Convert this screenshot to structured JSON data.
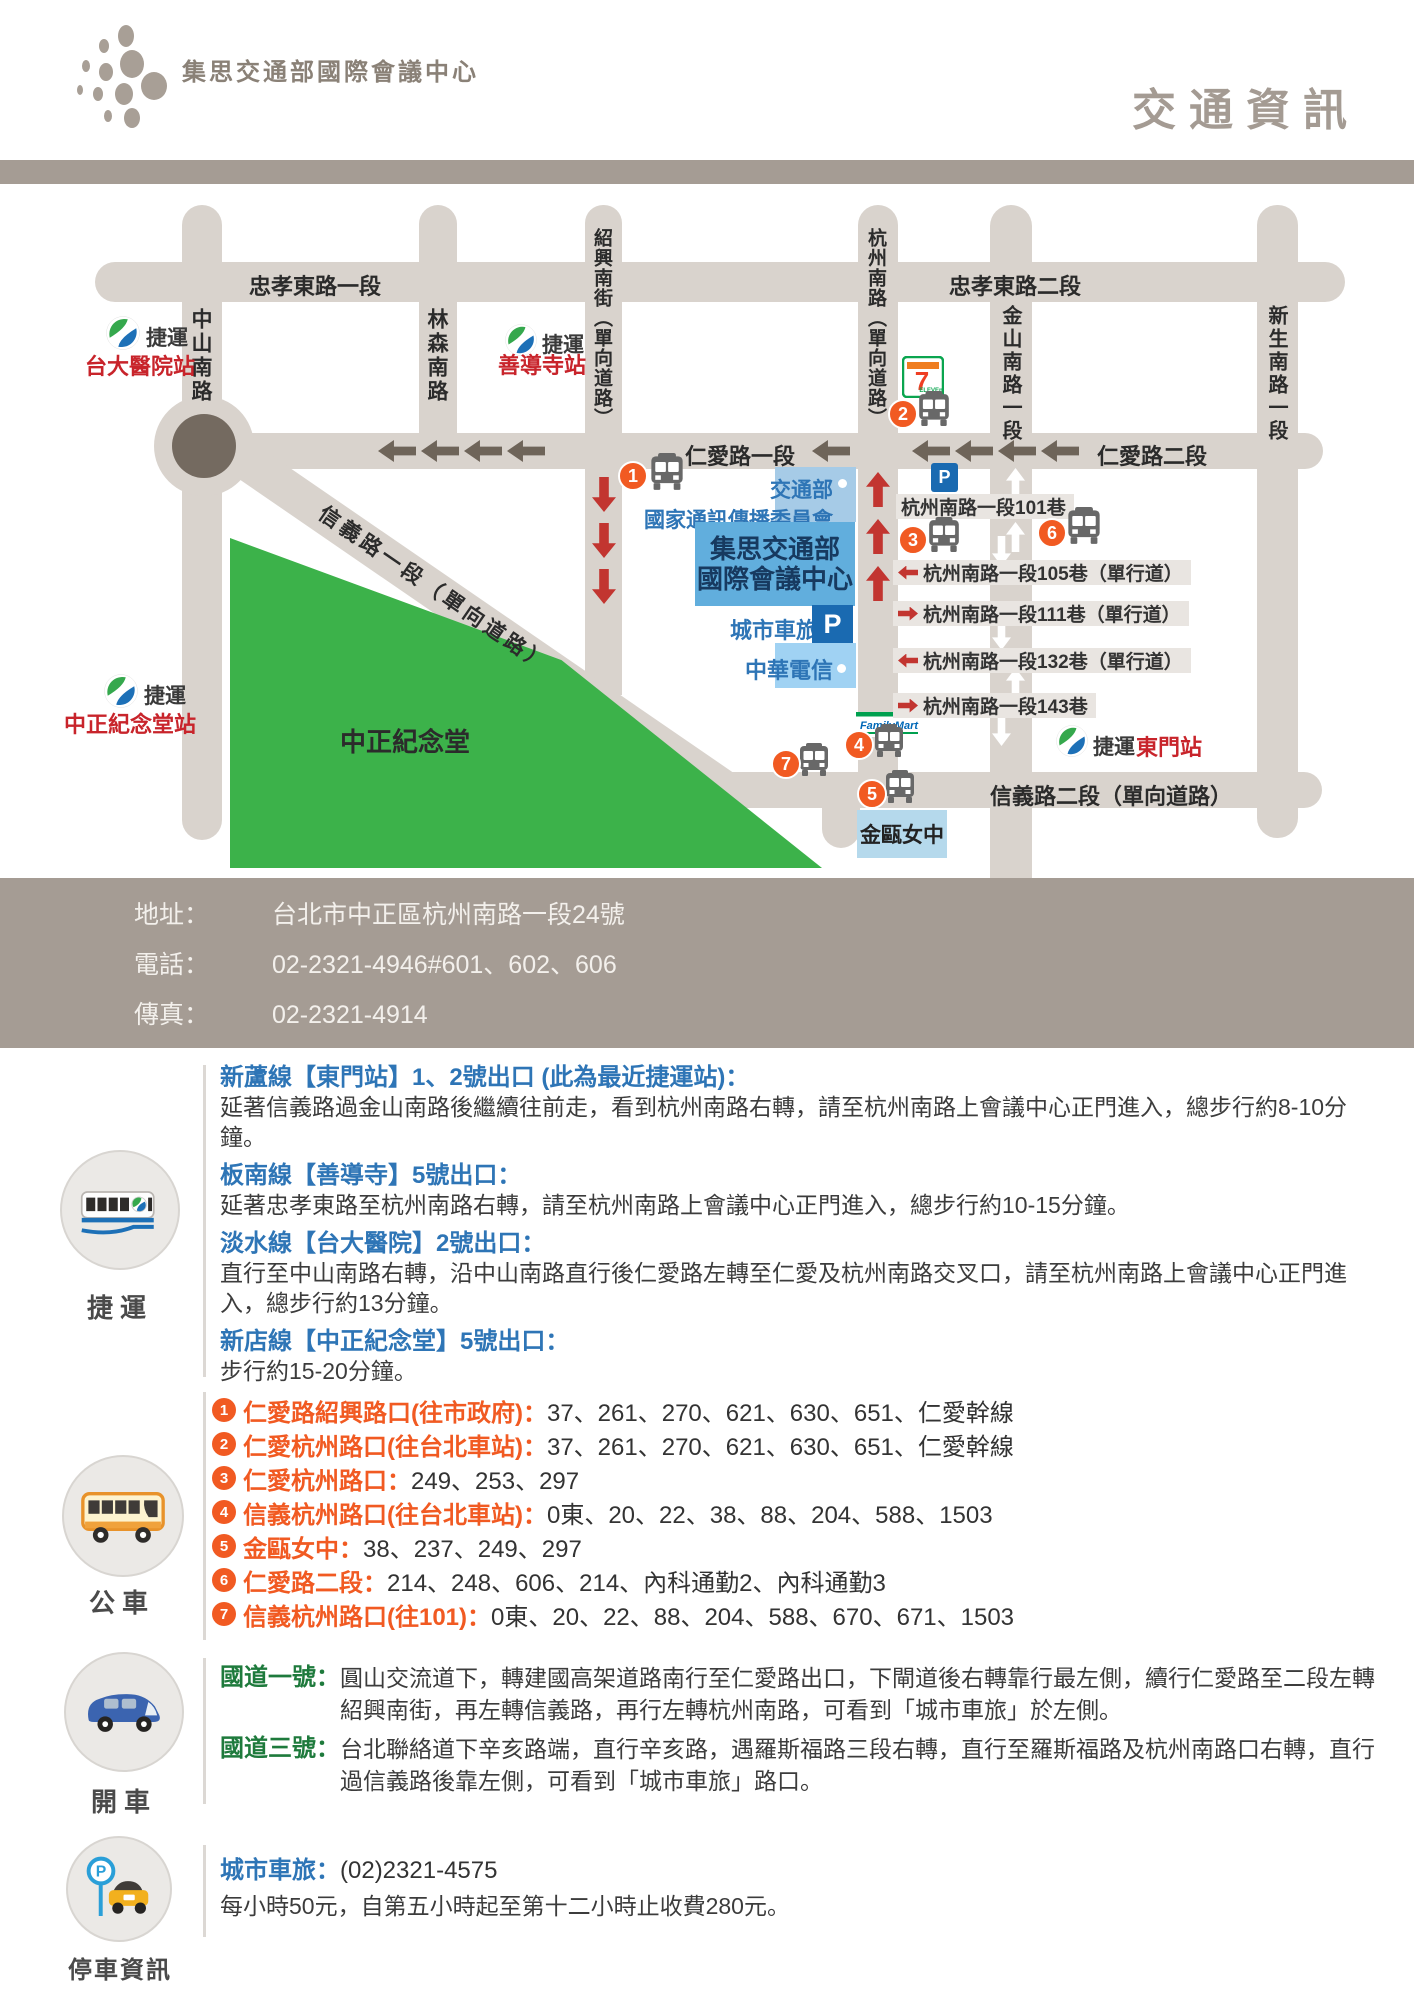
{
  "header": {
    "brand": "集思交通部國際會議中心",
    "page_title": "交通資訊"
  },
  "map": {
    "roads": {
      "zhongxiao1": "忠孝東路一段",
      "zhongxiao2": "忠孝東路二段",
      "zhongshan": "中山南路",
      "linsen": "林森南路",
      "shaoxing": "紹興南街（單向道路）",
      "hangzhou": "杭州南路（單向道路）",
      "jinshan": "金山南路一段",
      "xinsheng": "新生南路一段",
      "renai1": "仁愛路一段",
      "renai2": "仁愛路二段",
      "xinyi1": "信義路一段（單向道路）",
      "xinyi2": "信義路二段（單向道路）"
    },
    "stations": {
      "ntu_hospital": {
        "metro": "捷運",
        "name": "台大醫院站"
      },
      "shandao": {
        "metro": "捷運",
        "name": "善導寺站"
      },
      "cks": {
        "metro": "捷運",
        "name": "中正紀念堂站"
      },
      "dongmen": {
        "metro": "捷運",
        "name": "東門站"
      }
    },
    "buildings": {
      "ncc_line1": "交通部",
      "ncc_line2": "國家通訊傳播委員會",
      "gis_line1": "集思交通部",
      "gis_line2": "國際會議中心",
      "city_parking": "城市車旅",
      "p_letter": "P",
      "cht": "中華電信",
      "jinou": "金甌女中",
      "cks_memorial": "中正紀念堂",
      "seven_eleven": "7-ELEVEn",
      "familymart": "FamilyMart"
    },
    "lanes": [
      {
        "label": "杭州南路一段101巷"
      },
      {
        "label": "杭州南路一段105巷（單行道）"
      },
      {
        "label": "杭州南路一段111巷（單行道）"
      },
      {
        "label": "杭州南路一段132巷（單行道）"
      },
      {
        "label": "杭州南路一段143巷"
      }
    ],
    "stops": [
      "1",
      "2",
      "3",
      "4",
      "5",
      "6",
      "7"
    ]
  },
  "contact": {
    "rows": [
      {
        "label": "地址：",
        "value": "台北市中正區杭州南路一段24號"
      },
      {
        "label": "電話：",
        "value": "02-2321-4946#601、602、606"
      },
      {
        "label": "傳真：",
        "value": "02-2321-4914"
      }
    ]
  },
  "sections": {
    "mrt": {
      "label": "捷運",
      "items": [
        {
          "heading": "新蘆線【東門站】1、2號出口 (此為最近捷運站)：",
          "body": "延著信義路過金山南路後繼續往前走，看到杭州南路右轉，請至杭州南路上會議中心正門進入，總步行約8-10分鐘。"
        },
        {
          "heading": "板南線【善導寺】5號出口：",
          "body": "延著忠孝東路至杭州南路右轉，請至杭州南路上會議中心正門進入，總步行約10-15分鐘。"
        },
        {
          "heading": "淡水線【台大醫院】2號出口：",
          "body": "直行至中山南路右轉，沿中山南路直行後仁愛路左轉至仁愛及杭州南路交叉口，請至杭州南路上會議中心正門進入，總步行約13分鐘。"
        },
        {
          "heading": "新店線【中正紀念堂】5號出口：",
          "body": "步行約15-20分鐘。"
        }
      ]
    },
    "bus": {
      "label": "公車",
      "routes": [
        {
          "num": "1",
          "stop": "仁愛路紹興路口(往市政府)：",
          "lines": "37、261、270、621、630、651、仁愛幹線"
        },
        {
          "num": "2",
          "stop": "仁愛杭州路口(往台北車站)：",
          "lines": "37、261、270、621、630、651、仁愛幹線"
        },
        {
          "num": "3",
          "stop": "仁愛杭州路口：",
          "lines": "249、253、297"
        },
        {
          "num": "4",
          "stop": "信義杭州路口(往台北車站)：",
          "lines": "0東、20、22、38、88、204、588、1503"
        },
        {
          "num": "5",
          "stop": "金甌女中：",
          "lines": "38、237、249、297"
        },
        {
          "num": "6",
          "stop": "仁愛路二段：",
          "lines": "214、248、606、214、內科通勤2、內科通勤3"
        },
        {
          "num": "7",
          "stop": "信義杭州路口(往101)：",
          "lines": "0東、20、22、88、204、588、670、671、1503"
        }
      ]
    },
    "drive": {
      "label": "開車",
      "items": [
        {
          "heading": "國道一號：",
          "body": "圓山交流道下，轉建國高架道路南行至仁愛路出口，下閘道後右轉靠行最左側，續行仁愛路至二段左轉紹興南街，再左轉信義路，再行左轉杭州南路，可看到「城市車旅」於左側。"
        },
        {
          "heading": "國道三號：",
          "body": "台北聯絡道下辛亥路端，直行辛亥路，遇羅斯福路三段右轉，直行至羅斯福路及杭州南路口右轉，直行過信義路後靠左側，可看到「城市車旅」路口。"
        }
      ]
    },
    "parking": {
      "label": "停車資訊",
      "heading": "城市車旅：",
      "phone": "(02)2321-4575",
      "body": "每小時50元，自第五小時起至第十二小時止收費280元。"
    }
  },
  "colors": {
    "band": "#a59c94",
    "road": "#d9d3cd",
    "road-dark": "#746a60",
    "arrow-dark": "#6e6459",
    "arrow-red": "#c23530",
    "park-green": "#3cb24a",
    "block-blue": "#61aedd",
    "block-lightblue": "#a6cbe7",
    "block-paleblue": "#a0d2f3",
    "block-softblue": "#b5d9ec",
    "p-blue": "#1a6ab1",
    "navy": "#173a60",
    "text-blue": "#2e75b6",
    "station-red": "#c8242b",
    "orange": "#f15a22",
    "hw-green": "#1e7a3c",
    "strip": "#e9e5e1",
    "body-text": "#3c3c3c",
    "title-gray": "#a49b93",
    "brand-gray": "#8a8177"
  }
}
